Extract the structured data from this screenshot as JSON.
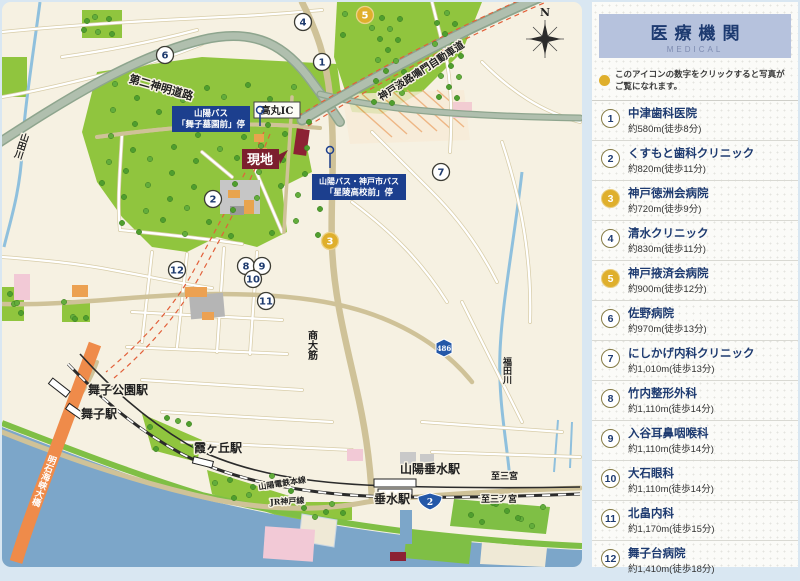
{
  "panel": {
    "title": "医療機関",
    "subtitle": "MEDICAL",
    "note": "このアイコンの数字をクリックすると写真がご覧になれます。",
    "items": [
      {
        "num": "1",
        "name": "中津歯科医院",
        "distance": "約580m(徒歩8分)",
        "highlight": false
      },
      {
        "num": "2",
        "name": "くすもと歯科クリニック",
        "distance": "約820m(徒歩11分)",
        "highlight": false
      },
      {
        "num": "3",
        "name": "神戸徳洲会病院",
        "distance": "約720m(徒歩9分)",
        "highlight": true
      },
      {
        "num": "4",
        "name": "清水クリニック",
        "distance": "約830m(徒歩11分)",
        "highlight": false
      },
      {
        "num": "5",
        "name": "神戸掖済会病院",
        "distance": "約900m(徒歩12分)",
        "highlight": true
      },
      {
        "num": "6",
        "name": "佐野病院",
        "distance": "約970m(徒歩13分)",
        "highlight": false
      },
      {
        "num": "7",
        "name": "にしかげ内科クリニック",
        "distance": "約1,010m(徒歩13分)",
        "highlight": false
      },
      {
        "num": "8",
        "name": "竹内整形外科",
        "distance": "約1,110m(徒歩14分)",
        "highlight": false
      },
      {
        "num": "9",
        "name": "入谷耳鼻咽喉科",
        "distance": "約1,110m(徒歩14分)",
        "highlight": false
      },
      {
        "num": "10",
        "name": "大石眼科",
        "distance": "約1,110m(徒歩14分)",
        "highlight": false
      },
      {
        "num": "11",
        "name": "北畠内科",
        "distance": "約1,170m(徒歩15分)",
        "highlight": false
      },
      {
        "num": "12",
        "name": "舞子台病院",
        "distance": "約1,410m(徒歩18分)",
        "highlight": false
      }
    ]
  },
  "map": {
    "site_label": "現地",
    "bus_stop_1": {
      "line1": "山陽バス",
      "line2": "「舞子墓園前」停"
    },
    "bus_stop_2": {
      "line1": "山陽バス・神戸市バス",
      "line2": "「星陵高校前」停"
    },
    "roads": {
      "dainishinmei": "第二神明道路",
      "kobe_awaji": "神戸淡路鳴門自動車道",
      "takamaru_ic": "高丸IC",
      "shodai_suji": "商大筋"
    },
    "rivers": {
      "yamada": "山田川",
      "fukuda": "福田川"
    },
    "bridge": "明石海峡大橋",
    "stations": {
      "maiko_koen": "舞子公園駅",
      "maiko": "舞子駅",
      "kasumigaoka": "霞ヶ丘駅",
      "sanyo_tarumi": "山陽垂水駅",
      "tarumi": "垂水駅"
    },
    "rail_lines": {
      "sanyo": "山陽電鉄本線",
      "jr": "JR神戸線"
    },
    "directions": {
      "sanyo": "至三宮",
      "jr": "至三ノ宮"
    },
    "route_badges": {
      "r2": "2",
      "r486": "486"
    },
    "compass": "N",
    "markers": [
      {
        "num": "1",
        "x": 320,
        "y": 60,
        "gold": false
      },
      {
        "num": "2",
        "x": 211,
        "y": 197,
        "gold": false
      },
      {
        "num": "3",
        "x": 328,
        "y": 239,
        "gold": true
      },
      {
        "num": "4",
        "x": 301,
        "y": 20,
        "gold": false
      },
      {
        "num": "5",
        "x": 363,
        "y": 13,
        "gold": true
      },
      {
        "num": "6",
        "x": 163,
        "y": 53,
        "gold": false
      },
      {
        "num": "7",
        "x": 439,
        "y": 170,
        "gold": false
      },
      {
        "num": "8",
        "x": 244,
        "y": 264,
        "gold": false
      },
      {
        "num": "9",
        "x": 260,
        "y": 264,
        "gold": false
      },
      {
        "num": "10",
        "x": 251,
        "y": 277,
        "gold": false
      },
      {
        "num": "11",
        "x": 264,
        "y": 299,
        "gold": false
      },
      {
        "num": "12",
        "x": 175,
        "y": 268,
        "gold": false
      }
    ]
  },
  "colors": {
    "accent_gold": "#dfaf2c",
    "navy": "#1d3a70",
    "site_red": "#7c1f2e",
    "bus_label_blue": "#1c3f8e",
    "sea": "#7ca6c9",
    "bridge_orange": "#ef8b4a",
    "park_green": "#90c53e",
    "header_lavender": "#b6c2dd"
  }
}
